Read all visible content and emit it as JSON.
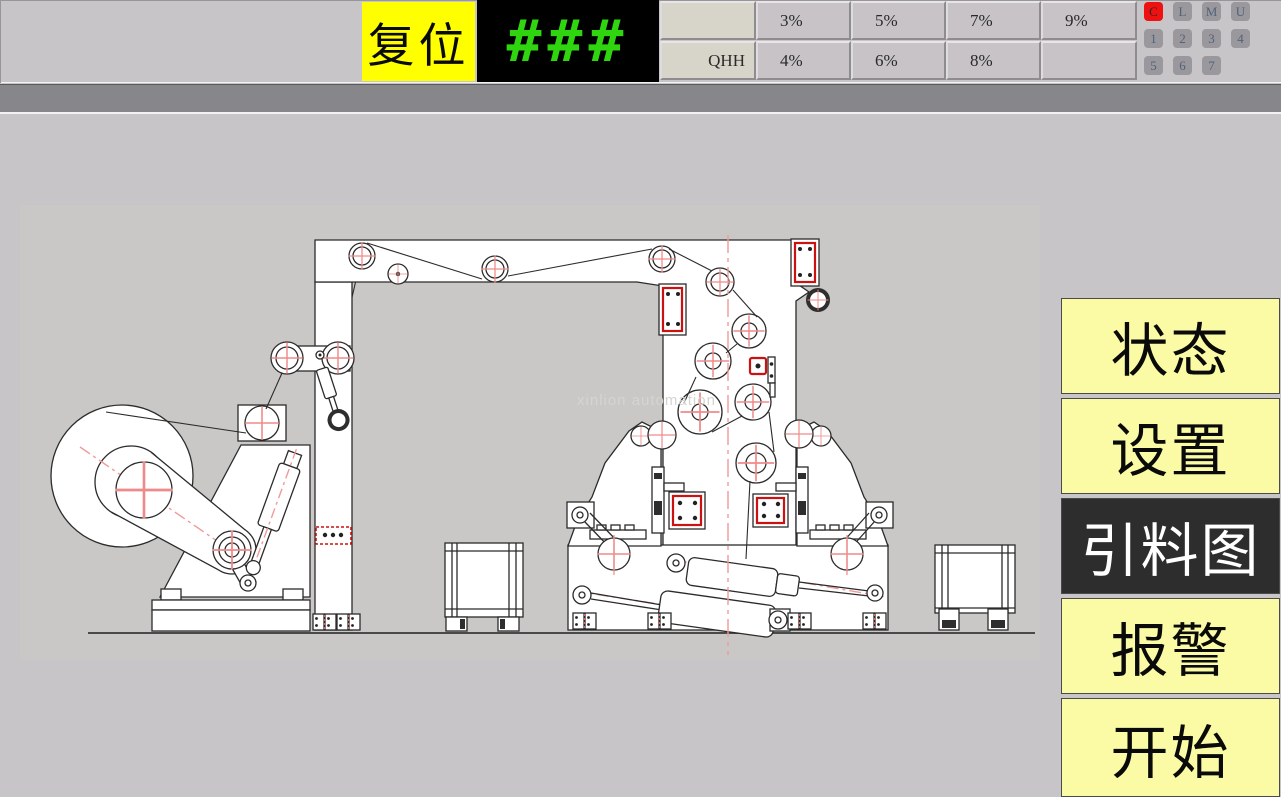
{
  "top_bar": {
    "reset_label": "复位",
    "display_value": "###",
    "param_grid": {
      "row1": [
        "",
        "3%",
        "5%",
        "7%",
        "9%"
      ],
      "row2": [
        "QHH",
        "4%",
        "6%",
        "8%",
        ""
      ]
    },
    "keypad_rows": [
      [
        "C",
        "L",
        "M",
        "U"
      ],
      [
        "1",
        "2",
        "3",
        "4"
      ],
      [
        "5",
        "6",
        "7"
      ]
    ],
    "active_key": "C"
  },
  "menu": {
    "items": [
      {
        "label": "状态",
        "active": false
      },
      {
        "label": "设置",
        "active": false
      },
      {
        "label": "引料图",
        "active": true
      },
      {
        "label": "报警",
        "active": false
      },
      {
        "label": "开始",
        "active": false
      }
    ]
  },
  "diagram": {
    "watermark": "xinlion automation"
  },
  "colors": {
    "reset_bg": "#ffff00",
    "display_green": "#2fd60f",
    "active_key_red": "#ee1111",
    "menu_yellow": "#fbfba5",
    "menu_active_bg": "#2d2d2d",
    "diagram_red": "#cc1111",
    "centerline_pink": "#ef9a9a"
  }
}
